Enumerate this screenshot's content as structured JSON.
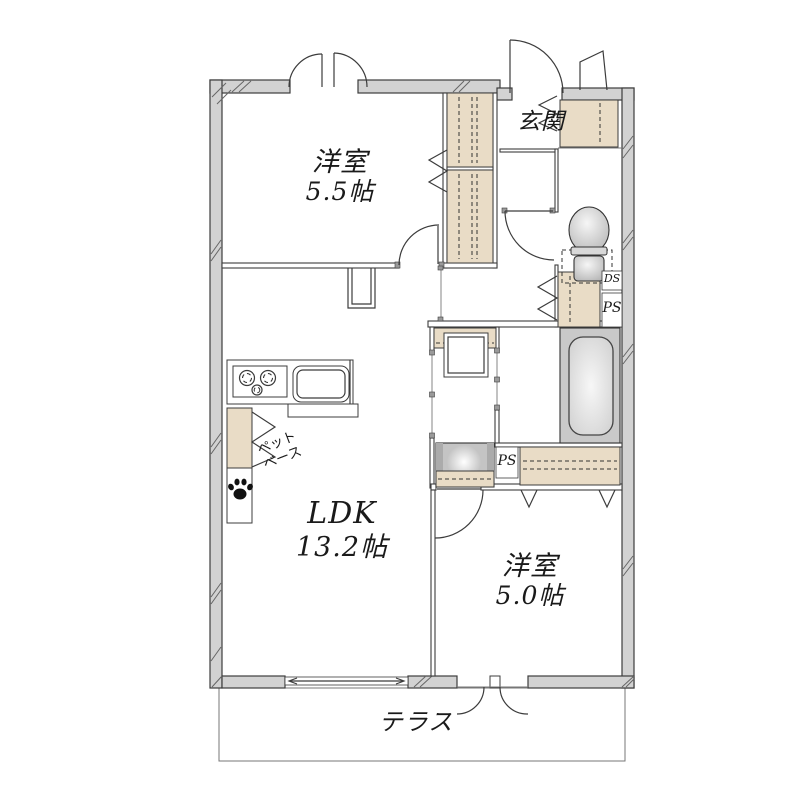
{
  "colors": {
    "wall_fill": "#d2d2d2",
    "line": "#3c3c3c",
    "tan": "#e9dcc6",
    "fixture": "#c9c9c9",
    "bg": "#ffffff"
  },
  "rooms": {
    "bedroom_a": {
      "name": "洋室",
      "size": "5.5帖"
    },
    "entrance": {
      "name": "玄関"
    },
    "ldk": {
      "name": "LDK",
      "size": "13.2帖"
    },
    "bedroom_b": {
      "name": "洋室",
      "size": "5.0帖"
    },
    "terrace": {
      "name": "テラス"
    }
  },
  "annotations": {
    "duct_space": "DS",
    "pipe_space_hall": "PS",
    "pipe_space_bath": "PS",
    "pet_base_line1": "ペット",
    "pet_base_line2": "ベース"
  }
}
